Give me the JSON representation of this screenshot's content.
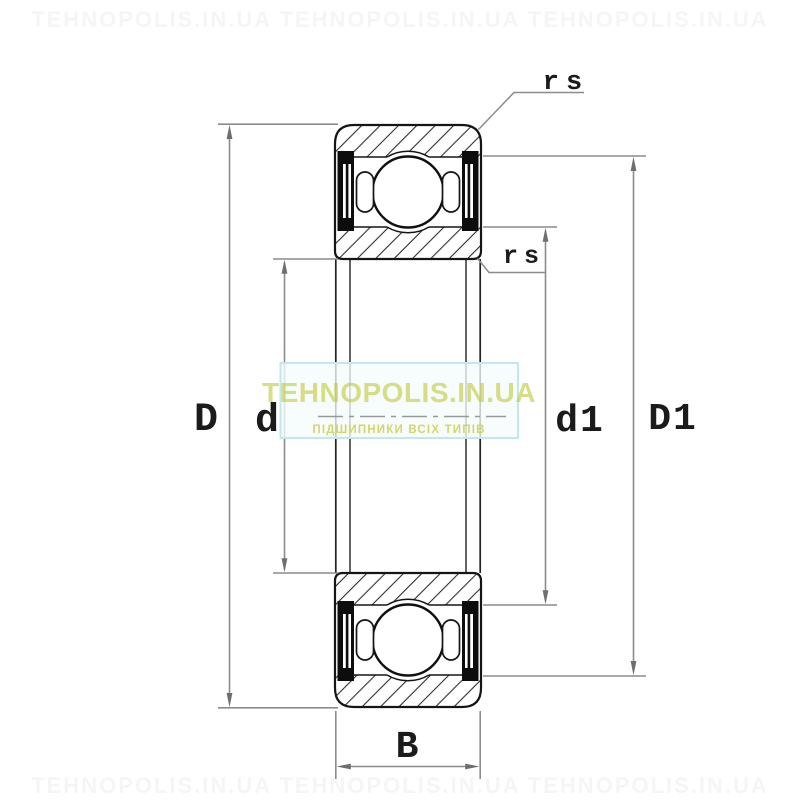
{
  "figure": {
    "type": "bearing-cross-section-drawing",
    "description": "Deep groove ball bearing 2RS sealed, axial cross-section with dimension callouts"
  },
  "dimensions": {
    "outer_diameter": {
      "label": "D"
    },
    "bore_diameter": {
      "label": "d"
    },
    "inner_shoulder_diameter": {
      "label": "d1"
    },
    "outer_shoulder_diameter": {
      "label": "D1"
    },
    "width": {
      "label": "B"
    },
    "chamfer_outer": {
      "label": "rs"
    },
    "chamfer_inner": {
      "label": "rs"
    }
  },
  "watermarks": {
    "ghost_row": "TEHNOPOLIS.IN.UA   TEHNOPOLIS.IN.UA   TEHNOPOLIS.IN.UA",
    "center": {
      "title": "TEHNOPOLIS.IN.UA",
      "subtitle": "ПІДШИПНИКИ ВСІХ ТИПІВ",
      "title_color": "#c1cb3d",
      "subtitle_color": "#ccd24e",
      "border_color": "#c3e7ef",
      "box_fill": "#f5fbfc"
    }
  },
  "style": {
    "outline_color": "#151515",
    "hatch_color": "#2e2e2e",
    "dimension_line_color": "#8c8c8c",
    "arrow_color": "#6e6e6e",
    "centerline_color": "#999999",
    "label_color": "#1b1b1b",
    "background": "#ffffff"
  }
}
